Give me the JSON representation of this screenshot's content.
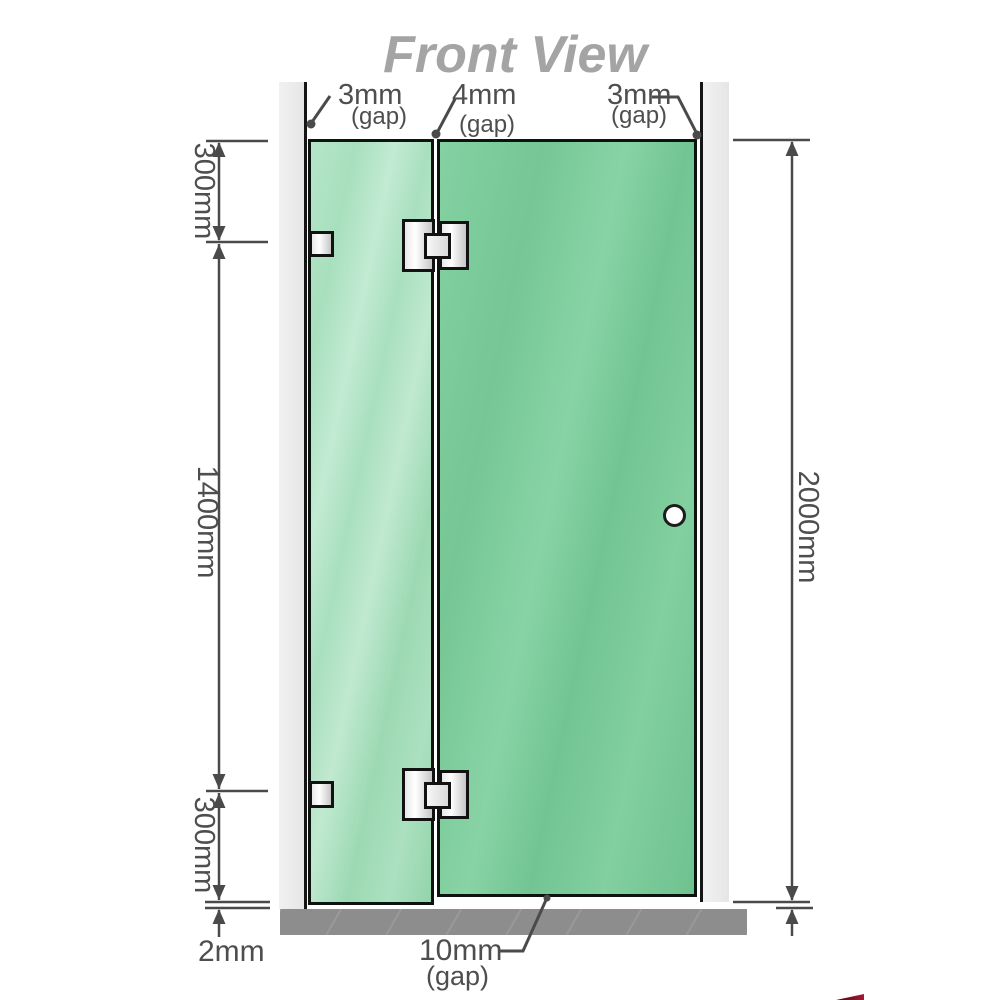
{
  "title": "Front View",
  "labels": {
    "gap_left_value": "3mm",
    "gap_left_suffix": "(gap)",
    "gap_mid_value": "4mm",
    "gap_mid_suffix": "(gap)",
    "gap_right_value": "3mm",
    "gap_right_suffix": "(gap)",
    "dim_left_top": "300mm",
    "dim_left_mid": "1400mm",
    "dim_left_bottom": "300mm",
    "dim_floor_gap": "2mm",
    "dim_right_height": "2000mm",
    "dim_door_bottom_value": "10mm",
    "dim_door_bottom_suffix": "(gap)"
  },
  "colors": {
    "glass_fixed_panel": "#a8dfbd",
    "glass_door_panel": "#77c896",
    "wall": "#e9e9e9",
    "floor": "#8d8d8d",
    "dimension_lines": "#4a4a4a",
    "title_text": "#a4a4a4",
    "hardware_fill": "#ffffff",
    "outline": "#121212",
    "watermark_red": "#a61a32"
  },
  "components": {
    "left_wall": "wall",
    "right_wall": "wall",
    "fixed_glass_panel": "fixed glass panel",
    "door_glass_panel": "hinged glass door",
    "wall_brackets": "wall-bracket",
    "glass_hinges": "glass-to-glass hinge",
    "door_knob": "round door knob",
    "floor_base": "floor"
  }
}
